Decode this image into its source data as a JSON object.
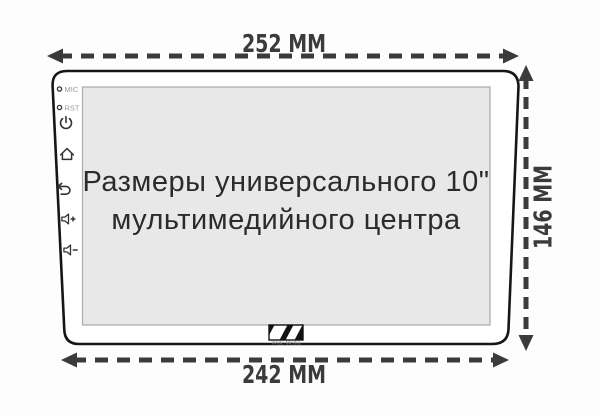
{
  "diagram": {
    "screen_title_line1": "Размеры универсального 10\"",
    "screen_title_line2": "мультимедийного центра"
  },
  "dimensions": {
    "top_width": "252 ММ",
    "bottom_width": "242 ММ",
    "right_height": "146 ММ"
  },
  "side_panel": {
    "mic_label": "MIC",
    "rst_label": "RST",
    "button_icons": [
      "power",
      "home",
      "back",
      "volume-up",
      "volume-down"
    ]
  },
  "brand": {
    "name": "Wide Media"
  },
  "colors": {
    "dimension": "#3b3b3b",
    "device_outline": "#161616",
    "device_fill": "#ffffff",
    "screen_bg": "#e8e8e8",
    "screen_border": "#ababab",
    "title_text": "#2b2b2b",
    "side_label_text": "#9a9a9a",
    "icon": "#333333"
  }
}
